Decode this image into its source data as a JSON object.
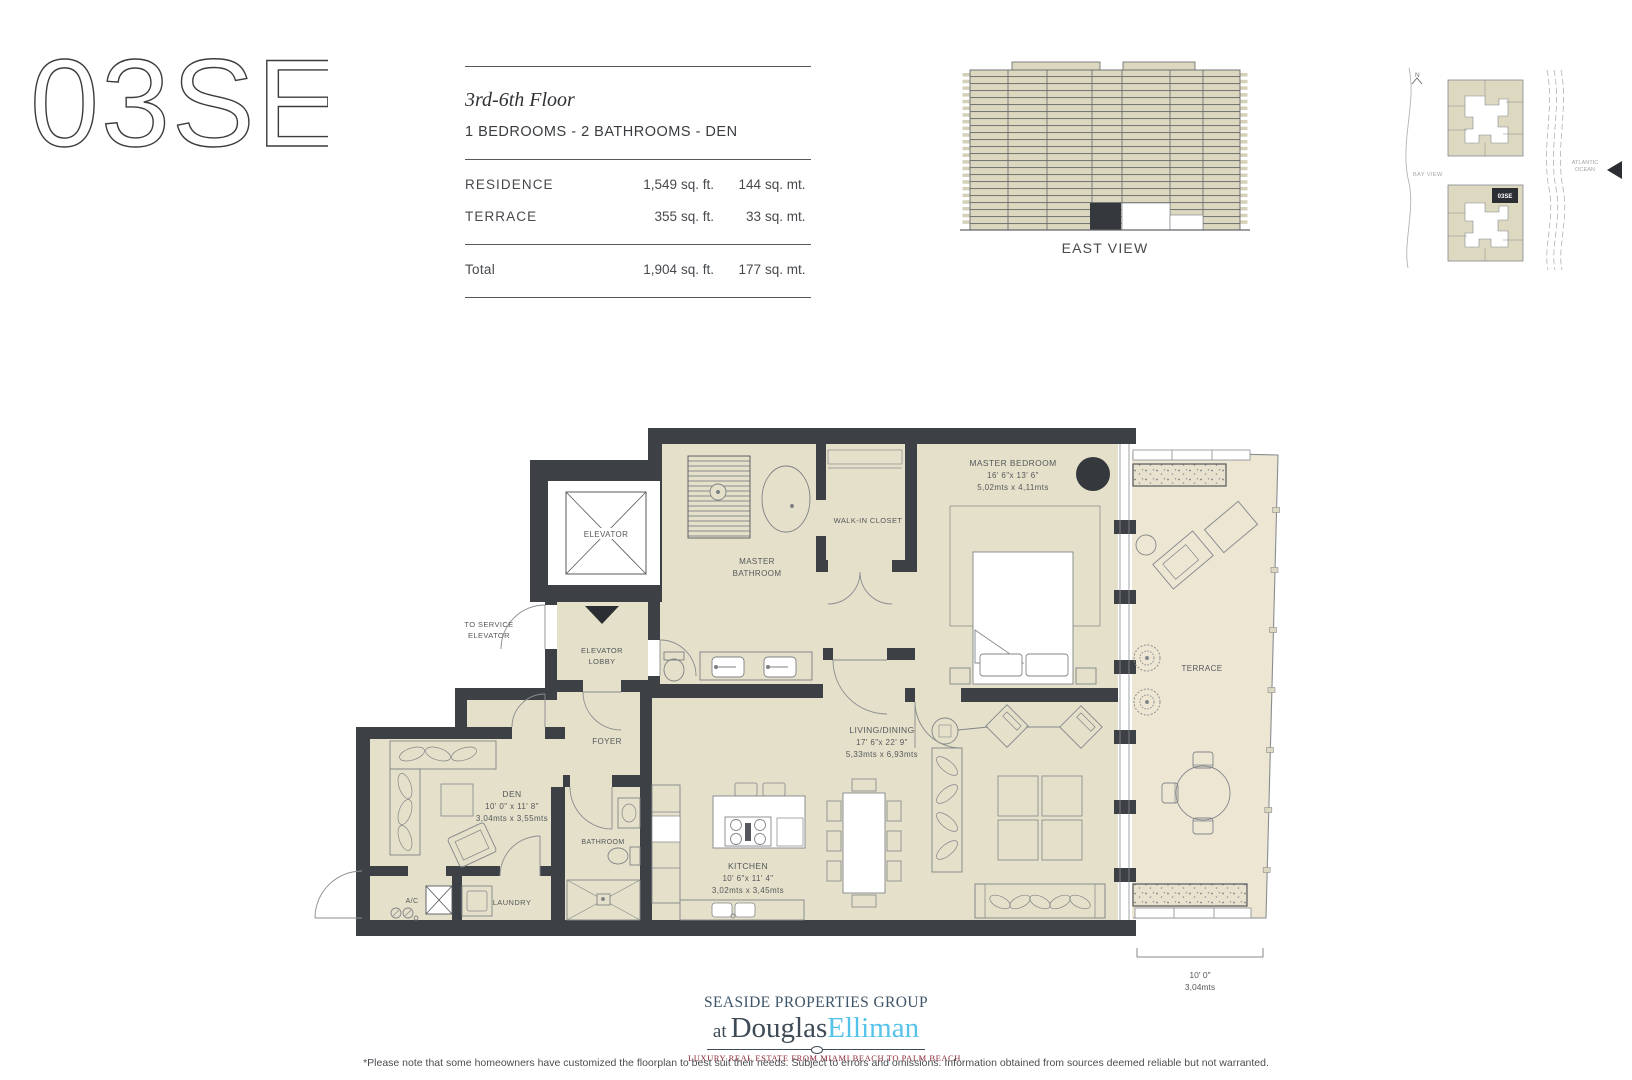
{
  "colors": {
    "wall": "#3d4045",
    "interior_fill": "#e4e0c9",
    "terrace_fill": "#ece6d3",
    "elevation_band": "#dcd8bf",
    "brand_navy": "#3e4a55",
    "brand_blue": "#55c3e9",
    "tagline_red": "#8b2332"
  },
  "header": {
    "unit": "03SE",
    "floor_range": "3rd-6th Floor",
    "configuration": "1 BEDROOMS - 2 BATHROOMS - DEN",
    "area_rows": [
      {
        "label": "RESIDENCE",
        "sqft": "1,549",
        "sqft_unit": "sq. ft.",
        "sqmt": "144",
        "sqmt_unit": "sq. mt."
      },
      {
        "label": "TERRACE",
        "sqft": "355",
        "sqft_unit": "sq. ft.",
        "sqmt": "33",
        "sqmt_unit": "sq. mt."
      }
    ],
    "total_row": {
      "label": "Total",
      "sqft": "1,904",
      "sqft_unit": "sq. ft.",
      "sqmt": "177",
      "sqmt_unit": "sq. mt."
    }
  },
  "east_view": {
    "label": "EAST VIEW"
  },
  "keyplan": {
    "north": "N",
    "bay": "BAY VIEW",
    "ocean_line1": "ATLANTIC",
    "ocean_line2": "OCEAN",
    "badge": "03SE"
  },
  "floorplan": {
    "elevator": "ELEVATOR",
    "to_service_1": "TO SERVICE",
    "to_service_2": "ELEVATOR",
    "lobby_1": "ELEVATOR",
    "lobby_2": "LOBBY",
    "master_bath_1": "MASTER",
    "master_bath_2": "BATHROOM",
    "walk_in_closet": "WALK-IN CLOSET",
    "master_bedroom": {
      "name": "MASTER BEDROOM",
      "imperial": "16' 6\"x 13' 6\"",
      "metric": "5,02mts x 4,11mts"
    },
    "foyer": "FOYER",
    "den": {
      "name": "DEN",
      "imperial": "10' 0\" x 11' 8\"",
      "metric": "3,04mts x 3,55mts"
    },
    "bathroom": "BATHROOM",
    "laundry": "LAUNDRY",
    "ac": "A/C",
    "kitchen": {
      "name": "KITCHEN",
      "imperial": "10' 6\"x 11' 4\"",
      "metric": "3,02mts x 3,45mts"
    },
    "living": {
      "name": "LIVING/DINING",
      "imperial": "17' 6\"x 22' 9\"",
      "metric": "5,33mts x 6,93mts"
    },
    "terrace": "TERRACE",
    "terrace_dim": {
      "imperial": "10' 0\"",
      "metric": "3,04mts"
    }
  },
  "footer": {
    "brand_line1": "SEASIDE PROPERTIES GROUP",
    "brand_at": "at",
    "brand_name_dark": "Douglas",
    "brand_name_light": "Elliman",
    "tagline": "LUXURY REAL ESTATE FROM MIAMI BEACH TO PALM BEACH",
    "disclaimer": "*Please note that some homeowners have customized the floorplan to best suit their needs. Subject to errors and omissions. Information obtained from sources deemed reliable but not warranted."
  }
}
